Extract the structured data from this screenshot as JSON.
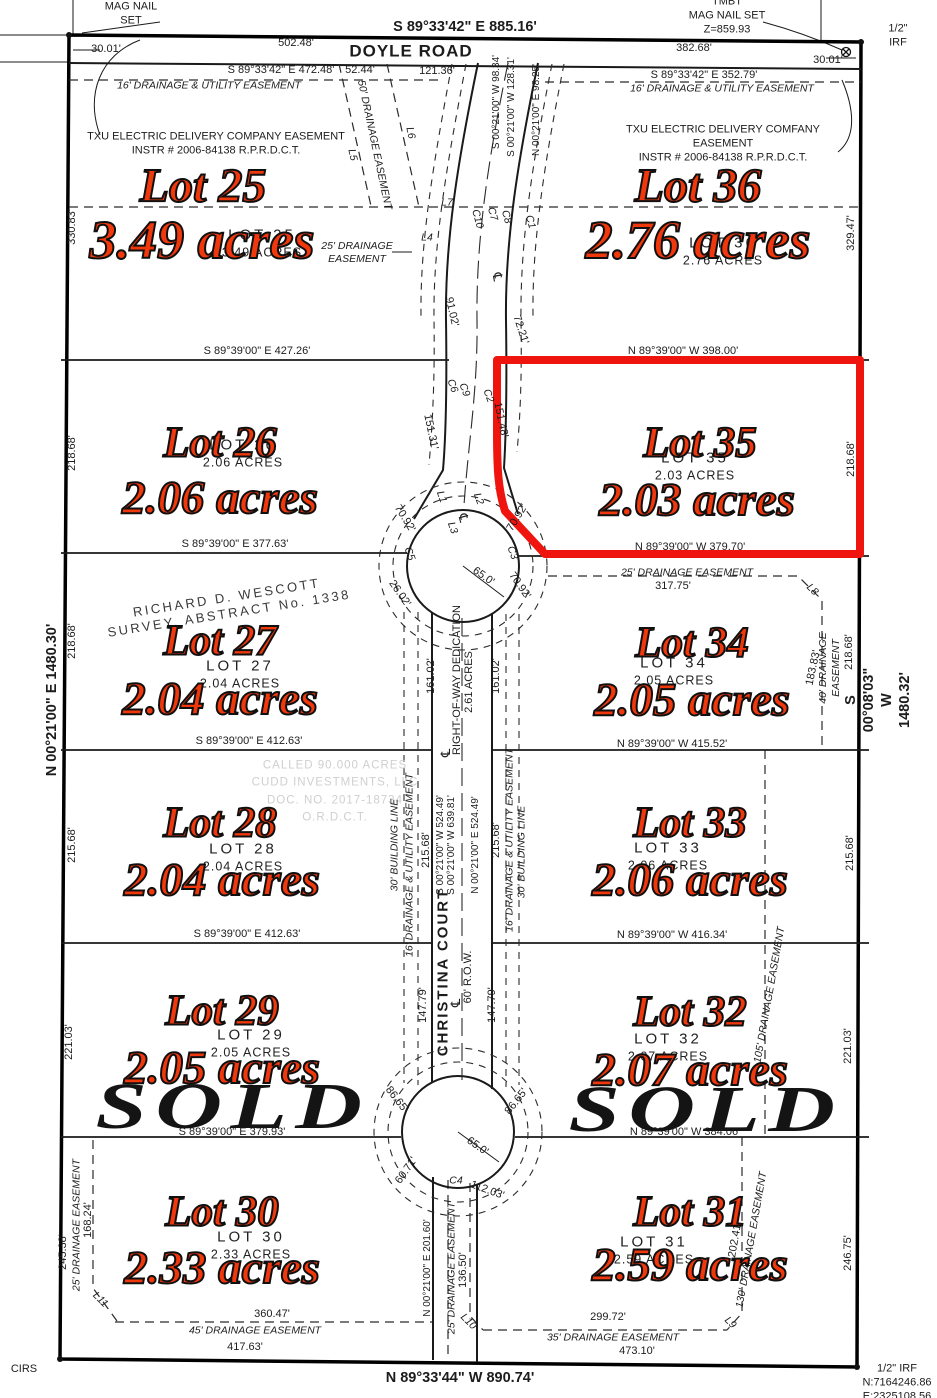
{
  "page": {
    "kind": "subdivision plat survey map"
  },
  "colors": {
    "lot_label_red": "#f0380c",
    "highlight_red": "#f0140f",
    "linework_black": "#1a1a1a",
    "faint_gray": "#cfcfcf",
    "sold_black": "#141414"
  },
  "roads": {
    "doyle": "DOYLE ROAD",
    "christina": "CHRISTINA COURT",
    "row": "60' R.O.W."
  },
  "sold_text": "SOLD",
  "lots": [
    {
      "id": "lot-25",
      "num": "Lot 25",
      "acres": "3.49 acres",
      "plat_num": "LOT 25",
      "plat_acres": "3.49 ACRES",
      "big": true,
      "sold": false,
      "highlight": false,
      "nx": 203,
      "ny": 186,
      "ax": 202,
      "ay": 240,
      "px": 262,
      "py": 243
    },
    {
      "id": "lot-36",
      "num": "Lot 36",
      "acres": "2.76 acres",
      "plat_num": "LOT 36",
      "plat_acres": "2.76 ACRES",
      "big": true,
      "sold": false,
      "highlight": false,
      "nx": 698,
      "ny": 186,
      "ax": 698,
      "ay": 240,
      "px": 723,
      "py": 251
    },
    {
      "id": "lot-26",
      "num": "Lot 26",
      "acres": "2.06 acres",
      "plat_num": "LOT 26",
      "plat_acres": "2.06 ACRES",
      "big": false,
      "sold": false,
      "highlight": false,
      "nx": 220,
      "ny": 443,
      "ax": 220,
      "ay": 498,
      "px": 243,
      "py": 453
    },
    {
      "id": "lot-35",
      "num": "Lot 35",
      "acres": "2.03 acres",
      "plat_num": "LOT 35",
      "plat_acres": "2.03 ACRES",
      "big": false,
      "sold": false,
      "highlight": true,
      "nx": 700,
      "ny": 443,
      "ax": 697,
      "ay": 500,
      "px": 695,
      "py": 466
    },
    {
      "id": "lot-27",
      "num": "Lot 27",
      "acres": "2.04 acres",
      "plat_num": "LOT 27",
      "plat_acres": "2.04 ACRES",
      "big": false,
      "sold": false,
      "highlight": false,
      "nx": 220,
      "ny": 641,
      "ax": 220,
      "ay": 699,
      "px": 240,
      "py": 674
    },
    {
      "id": "lot-34",
      "num": "Lot 34",
      "acres": "2.05 acres",
      "plat_num": "LOT 34",
      "plat_acres": "2.05 ACRES",
      "big": false,
      "sold": false,
      "highlight": false,
      "nx": 692,
      "ny": 643,
      "ax": 692,
      "ay": 700,
      "px": 674,
      "py": 671
    },
    {
      "id": "lot-28",
      "num": "Lot 28",
      "acres": "2.04 acres",
      "plat_num": "LOT 28",
      "plat_acres": "2.04 ACRES",
      "big": false,
      "sold": false,
      "highlight": false,
      "nx": 220,
      "ny": 823,
      "ax": 222,
      "ay": 880,
      "px": 243,
      "py": 857
    },
    {
      "id": "lot-33",
      "num": "Lot 33",
      "acres": "2.06 acres",
      "plat_num": "LOT 33",
      "plat_acres": "2.06 ACRES",
      "big": false,
      "sold": false,
      "highlight": false,
      "nx": 690,
      "ny": 823,
      "ax": 690,
      "ay": 880,
      "px": 668,
      "py": 856
    },
    {
      "id": "lot-29",
      "num": "Lot 29",
      "acres": "2.05 acres",
      "plat_num": "LOT 29",
      "plat_acres": "2.05 ACRES",
      "big": false,
      "sold": true,
      "sx": 233,
      "sy": 1107,
      "highlight": false,
      "nx": 222,
      "ny": 1011,
      "ax": 222,
      "ay": 1068,
      "px": 251,
      "py": 1043
    },
    {
      "id": "lot-32",
      "num": "Lot 32",
      "acres": "2.07 acres",
      "plat_num": "LOT 32",
      "plat_acres": "2.07 ACRES",
      "big": false,
      "sold": true,
      "sx": 706,
      "sy": 1110,
      "highlight": false,
      "nx": 690,
      "ny": 1012,
      "ax": 690,
      "ay": 1070,
      "px": 668,
      "py": 1047
    },
    {
      "id": "lot-30",
      "num": "Lot 30",
      "acres": "2.33 acres",
      "plat_num": "LOT 30",
      "plat_acres": "2.33 ACRES",
      "big": false,
      "sold": false,
      "highlight": false,
      "nx": 222,
      "ny": 1212,
      "ax": 222,
      "ay": 1268,
      "px": 251,
      "py": 1245
    },
    {
      "id": "lot-31",
      "num": "Lot 31",
      "acres": "2.59 acres",
      "plat_num": "LOT 31",
      "plat_acres": "2.59 ACRES",
      "big": false,
      "sold": false,
      "highlight": false,
      "nx": 690,
      "ny": 1212,
      "ax": 690,
      "ay": 1265,
      "px": 654,
      "py": 1250
    }
  ],
  "labels": [
    {
      "t": "MAG NAIL\nSET",
      "x": 131,
      "y": 14,
      "c": "b",
      "n": "mag-nail-set-note"
    },
    {
      "t": "TMBT\nMAG NAIL SET\nZ=859.93",
      "x": 727,
      "y": 16,
      "c": "b",
      "n": "tmbt-mag-nail-note"
    },
    {
      "t": "1/2\" IRF",
      "x": 898,
      "y": 36,
      "c": "b",
      "n": "half-inch-irf-ne"
    },
    {
      "t": "S 89°33'42\" E  885.16'",
      "x": 465,
      "y": 27,
      "c": "bb",
      "n": "north-boundary-bearing"
    },
    {
      "t": "30.01'",
      "x": 106,
      "y": 50,
      "c": "b"
    },
    {
      "t": "502.48'",
      "x": 296,
      "y": 44,
      "c": "b"
    },
    {
      "t": "DOYLE ROAD",
      "x": 411,
      "y": 51,
      "c": "t",
      "n": "doyle-road-label"
    },
    {
      "t": "382.68'",
      "x": 694,
      "y": 49,
      "c": "b"
    },
    {
      "t": "30.01'",
      "x": 828,
      "y": 61,
      "c": "b"
    },
    {
      "t": "S 89°33'42\" E  472.48'",
      "x": 281,
      "y": 71,
      "c": "b"
    },
    {
      "t": "52.44'",
      "x": 360,
      "y": 71,
      "c": "b"
    },
    {
      "t": "121.36'",
      "x": 437,
      "y": 72,
      "c": "b"
    },
    {
      "t": "S 89°33'42\" E  352.79'",
      "x": 704,
      "y": 76,
      "c": "b"
    },
    {
      "t": "16' DRAINAGE & UTILITY EASEMENT",
      "x": 209,
      "y": 86,
      "c": "e",
      "n": "drainage-utility-easement-nw"
    },
    {
      "t": "16' DRAINAGE & UTILITY EASEMENT",
      "x": 722,
      "y": 89,
      "c": "e",
      "n": "drainage-utility-easement-ne"
    },
    {
      "t": "TXU ELECTRIC DELIVERY COMPANY EASEMENT\nINSTR # 2006-84138 R.P.R.D.C.T.",
      "x": 216,
      "y": 144,
      "c": "b",
      "n": "txu-easement-west"
    },
    {
      "t": "TXU ELECTRIC DELIVERY COMFANY EASEMENT\nINSTR # 2006-84138 R.P.R.D.C.T.",
      "x": 723,
      "y": 144,
      "c": "b",
      "n": "txu-easement-east"
    },
    {
      "t": "50' DRAINAGE EASEMENT",
      "x": 374,
      "y": 145,
      "r": 78,
      "c": "e"
    },
    {
      "t": "L5",
      "x": 352,
      "y": 155,
      "r": 78,
      "c": "e"
    },
    {
      "t": "L6",
      "x": 410,
      "y": 133,
      "r": 78,
      "c": "e"
    },
    {
      "t": "L7",
      "x": 447,
      "y": 203,
      "c": "e"
    },
    {
      "t": "L4",
      "x": 427,
      "y": 238,
      "c": "e"
    },
    {
      "t": "25' DRAINAGE\nEASEMENT",
      "x": 357,
      "y": 253,
      "c": "e"
    },
    {
      "t": "C10",
      "x": 477,
      "y": 219,
      "r": 75,
      "c": "e"
    },
    {
      "t": "C7",
      "x": 492,
      "y": 214,
      "r": 75,
      "c": "e"
    },
    {
      "t": "C8",
      "x": 506,
      "y": 217,
      "r": 75,
      "c": "e"
    },
    {
      "t": "C1",
      "x": 530,
      "y": 222,
      "r": 75,
      "c": "e"
    },
    {
      "t": "℄",
      "x": 497,
      "y": 277,
      "r": 80,
      "c": "sym",
      "n": "centerline-symbol-north"
    },
    {
      "t": "91.02'",
      "x": 451,
      "y": 312,
      "r": 77,
      "c": "b"
    },
    {
      "t": "72.21'",
      "x": 520,
      "y": 330,
      "r": 72,
      "c": "b"
    },
    {
      "t": "C6",
      "x": 452,
      "y": 386,
      "r": 70,
      "c": "e"
    },
    {
      "t": "C9",
      "x": 464,
      "y": 390,
      "r": 70,
      "c": "e"
    },
    {
      "t": "C2",
      "x": 488,
      "y": 396,
      "r": 70,
      "c": "e"
    },
    {
      "t": "S 00°21'00\" W  98.34'",
      "x": 497,
      "y": 102,
      "r": -90,
      "c": "bs"
    },
    {
      "t": "S 00°21'00\" W  128.31'",
      "x": 512,
      "y": 107,
      "r": -90,
      "c": "bs"
    },
    {
      "t": "N 00°21'00\" E  98.25'",
      "x": 537,
      "y": 110,
      "r": -90,
      "c": "bs"
    },
    {
      "t": "330.83'",
      "x": 73,
      "y": 227,
      "r": -90,
      "c": "b"
    },
    {
      "t": "S 89°39'00\" E  427.26'",
      "x": 257,
      "y": 352,
      "c": "b"
    },
    {
      "t": "329.47'",
      "x": 852,
      "y": 233,
      "r": -90,
      "c": "b"
    },
    {
      "t": "N 89°39'00\" W  398.00'",
      "x": 683,
      "y": 352,
      "c": "b"
    },
    {
      "t": "218.68'",
      "x": 73,
      "y": 453,
      "r": -90,
      "c": "b"
    },
    {
      "t": "S 89°39'00\" E  377.63'",
      "x": 235,
      "y": 545,
      "c": "b"
    },
    {
      "t": "151.31'",
      "x": 430,
      "y": 432,
      "r": 78,
      "c": "b"
    },
    {
      "t": "151.48'",
      "x": 500,
      "y": 420,
      "r": 78,
      "c": "b"
    },
    {
      "t": "218.68'",
      "x": 852,
      "y": 459,
      "r": -90,
      "c": "b"
    },
    {
      "t": "N 89°39'00\" W  379.70'",
      "x": 690,
      "y": 548,
      "c": "b"
    },
    {
      "t": "L1",
      "x": 441,
      "y": 497,
      "r": 70,
      "c": "e"
    },
    {
      "t": "C5",
      "x": 409,
      "y": 554,
      "r": 70,
      "c": "e"
    },
    {
      "t": "70.92'",
      "x": 404,
      "y": 519,
      "r": 58,
      "c": "b"
    },
    {
      "t": "L3",
      "x": 452,
      "y": 528,
      "r": 70,
      "c": "e"
    },
    {
      "t": "℄",
      "x": 463,
      "y": 518,
      "r": 75,
      "c": "sym",
      "n": "centerline-symbol-bulb-north"
    },
    {
      "t": "L2",
      "x": 478,
      "y": 499,
      "r": 70,
      "c": "e"
    },
    {
      "t": "C3",
      "x": 512,
      "y": 553,
      "r": 70,
      "c": "e"
    },
    {
      "t": "65.0'",
      "x": 483,
      "y": 577,
      "r": 35,
      "c": "b"
    },
    {
      "t": "70.92'",
      "x": 518,
      "y": 518,
      "r": -58,
      "c": "b"
    },
    {
      "t": "70.92'",
      "x": 519,
      "y": 586,
      "r": 55,
      "c": "b"
    },
    {
      "t": "26.02'",
      "x": 399,
      "y": 594,
      "r": 55,
      "c": "b"
    },
    {
      "t": "25' DRAINAGE EASEMENT",
      "x": 687,
      "y": 573,
      "c": "e"
    },
    {
      "t": "317.75'",
      "x": 673,
      "y": 587,
      "c": "b"
    },
    {
      "t": "L8",
      "x": 812,
      "y": 590,
      "r": 45,
      "c": "e"
    },
    {
      "t": "RICHARD D. WESCOTT\nSURVEY, ABSTRACT No. 1338",
      "x": 228,
      "y": 606,
      "r": -9,
      "c": "survey",
      "n": "survey-abstract-note"
    },
    {
      "t": "218.68'",
      "x": 73,
      "y": 641,
      "r": -90,
      "c": "b"
    },
    {
      "t": "S 89°39'00\" E  412.63'",
      "x": 249,
      "y": 742,
      "c": "b"
    },
    {
      "t": "161.02'",
      "x": 432,
      "y": 676,
      "r": -90,
      "c": "b"
    },
    {
      "t": "RIGHT-OF-WAY DEDICATION",
      "x": 458,
      "y": 680,
      "r": -90,
      "c": "b",
      "n": "row-dedication-label"
    },
    {
      "t": "2.61 ACRES",
      "x": 470,
      "y": 682,
      "r": -90,
      "c": "b"
    },
    {
      "t": "161.02'",
      "x": 497,
      "y": 676,
      "r": -90,
      "c": "b"
    },
    {
      "t": "℄",
      "x": 446,
      "y": 753,
      "r": -90,
      "c": "sym",
      "n": "centerline-symbol-mid"
    },
    {
      "t": "183.83'",
      "x": 814,
      "y": 668,
      "r": -78,
      "c": "b"
    },
    {
      "t": "40' DRAINAGE EASEMENT",
      "x": 830,
      "y": 668,
      "r": -90,
      "c": "e"
    },
    {
      "t": "218.68'",
      "x": 850,
      "y": 652,
      "r": -90,
      "c": "b"
    },
    {
      "t": "S 00°08'03\" W  1480.32'",
      "x": 878,
      "y": 700,
      "r": -90,
      "c": "bb",
      "n": "east-boundary-bearing"
    },
    {
      "t": "N 89°39'00\" W  415.52'",
      "x": 672,
      "y": 745,
      "c": "b"
    },
    {
      "t": "N 00°21'00\" E  1480.30'",
      "x": 52,
      "y": 700,
      "r": -90,
      "c": "bb",
      "n": "west-boundary-bearing"
    },
    {
      "t": "CALLED 90.000 ACRES\nCUDD INVESTMENTS, LLC\nDOC. NO. 2017-18734\nO.R.D.C.T.",
      "x": 335,
      "y": 792,
      "c": "faint",
      "n": "adjoining-tract-note"
    },
    {
      "t": "215.68'",
      "x": 73,
      "y": 845,
      "r": -90,
      "c": "b"
    },
    {
      "t": "S 89°39'00\" E  412.63'",
      "x": 247,
      "y": 935,
      "c": "b"
    },
    {
      "t": "30' BUILDING LINE",
      "x": 395,
      "y": 845,
      "r": -90,
      "c": "e"
    },
    {
      "t": "16' DRAINAGE & UTILITY EASEMENT",
      "x": 410,
      "y": 865,
      "r": -90,
      "c": "e"
    },
    {
      "t": "215.68'",
      "x": 427,
      "y": 850,
      "r": -90,
      "c": "b"
    },
    {
      "t": "S 00°21'00\" W  524.49'",
      "x": 441,
      "y": 845,
      "r": -90,
      "c": "bs"
    },
    {
      "t": "S 00°21'00\" W  639.81'",
      "x": 452,
      "y": 845,
      "r": -90,
      "c": "bs"
    },
    {
      "t": "N 00°21'00\" E  524.49'",
      "x": 476,
      "y": 845,
      "r": -90,
      "c": "bs"
    },
    {
      "t": "215.68'",
      "x": 497,
      "y": 840,
      "r": -90,
      "c": "b"
    },
    {
      "t": "16' DRAINAGE & UTILITY EASEMENT",
      "x": 510,
      "y": 840,
      "r": -90,
      "c": "e"
    },
    {
      "t": "30' BUILDING LINE",
      "x": 522,
      "y": 852,
      "r": -90,
      "c": "e"
    },
    {
      "t": "215.68'",
      "x": 851,
      "y": 853,
      "r": -90,
      "c": "b"
    },
    {
      "t": "N 89°39'00\" W  416.34'",
      "x": 672,
      "y": 936,
      "c": "b"
    },
    {
      "t": "105' DRAINAGE EASEMENT",
      "x": 770,
      "y": 995,
      "r": -80,
      "c": "e"
    },
    {
      "t": "221.03'",
      "x": 70,
      "y": 1042,
      "r": -90,
      "c": "b"
    },
    {
      "t": "S 89°39'00\" E  379.93'",
      "x": 232,
      "y": 1133,
      "c": "b"
    },
    {
      "t": "CHRISTINA COURT",
      "x": 444,
      "y": 972,
      "r": -90,
      "c": "road",
      "n": "christina-court-label"
    },
    {
      "t": "℄",
      "x": 456,
      "y": 1003,
      "r": -90,
      "c": "sym",
      "n": "centerline-symbol-south"
    },
    {
      "t": "60' R.O.W.",
      "x": 469,
      "y": 977,
      "r": -90,
      "c": "b",
      "n": "row-width-label"
    },
    {
      "t": "147.79'",
      "x": 424,
      "y": 1005,
      "r": -90,
      "c": "b"
    },
    {
      "t": "147.79'",
      "x": 493,
      "y": 1005,
      "r": -90,
      "c": "b"
    },
    {
      "t": "221.03'",
      "x": 849,
      "y": 1046,
      "r": -90,
      "c": "b"
    },
    {
      "t": "N 89°39'00\" W  384.06'",
      "x": 685,
      "y": 1133,
      "c": "b"
    },
    {
      "t": "86.65'",
      "x": 396,
      "y": 1100,
      "r": 52,
      "c": "b"
    },
    {
      "t": "86.65'",
      "x": 517,
      "y": 1102,
      "r": -52,
      "c": "b"
    },
    {
      "t": "60.71'",
      "x": 407,
      "y": 1171,
      "r": -55,
      "c": "b"
    },
    {
      "t": "65.0'",
      "x": 477,
      "y": 1147,
      "r": 35,
      "c": "b"
    },
    {
      "t": "C4",
      "x": 456,
      "y": 1181,
      "c": "e"
    },
    {
      "t": "112.03'",
      "x": 487,
      "y": 1191,
      "r": 20,
      "c": "b"
    },
    {
      "t": "N 00°21'00\" E  201.60'",
      "x": 428,
      "y": 1268,
      "r": -90,
      "c": "bs"
    },
    {
      "t": "25' DRAINAGE EASEMENT",
      "x": 452,
      "y": 1268,
      "r": -90,
      "c": "e"
    },
    {
      "t": "136.50'",
      "x": 464,
      "y": 1270,
      "r": -90,
      "c": "b"
    },
    {
      "t": "L10",
      "x": 468,
      "y": 1322,
      "r": 45,
      "c": "e"
    },
    {
      "t": "245.38'",
      "x": 64,
      "y": 1252,
      "r": -90,
      "c": "b"
    },
    {
      "t": "25' DRAINAGE EASEMENT",
      "x": 77,
      "y": 1225,
      "r": -90,
      "c": "e"
    },
    {
      "t": "168.24'",
      "x": 89,
      "y": 1220,
      "r": -90,
      "c": "b"
    },
    {
      "t": "L11",
      "x": 100,
      "y": 1300,
      "r": 45,
      "c": "e"
    },
    {
      "t": "360.47'",
      "x": 272,
      "y": 1315,
      "c": "b"
    },
    {
      "t": "45' DRAINAGE EASEMENT",
      "x": 255,
      "y": 1331,
      "c": "e"
    },
    {
      "t": "417.63'",
      "x": 245,
      "y": 1348,
      "c": "b"
    },
    {
      "t": "CIRS",
      "x": 24,
      "y": 1370,
      "c": "b",
      "n": "cirs-corner-note"
    },
    {
      "t": "202.41'",
      "x": 736,
      "y": 1240,
      "r": -80,
      "c": "b"
    },
    {
      "t": "130' DRAINAGE EASEMENT",
      "x": 752,
      "y": 1240,
      "r": -80,
      "c": "e"
    },
    {
      "t": "246.75'",
      "x": 849,
      "y": 1253,
      "r": -90,
      "c": "b"
    },
    {
      "t": "L9",
      "x": 730,
      "y": 1323,
      "r": 45,
      "c": "e"
    },
    {
      "t": "299.72'",
      "x": 608,
      "y": 1318,
      "c": "b"
    },
    {
      "t": "35' DRAINAGE EASEMENT",
      "x": 613,
      "y": 1338,
      "c": "e"
    },
    {
      "t": "473.10'",
      "x": 637,
      "y": 1352,
      "c": "b"
    },
    {
      "t": "N 89°33'44\" W  890.74'",
      "x": 460,
      "y": 1378,
      "c": "bb",
      "n": "south-boundary-bearing"
    },
    {
      "t": "1/2\" IRF\nN:7164246.86\nE:2325108.56",
      "x": 897,
      "y": 1383,
      "c": "b",
      "n": "half-inch-irf-se"
    }
  ]
}
